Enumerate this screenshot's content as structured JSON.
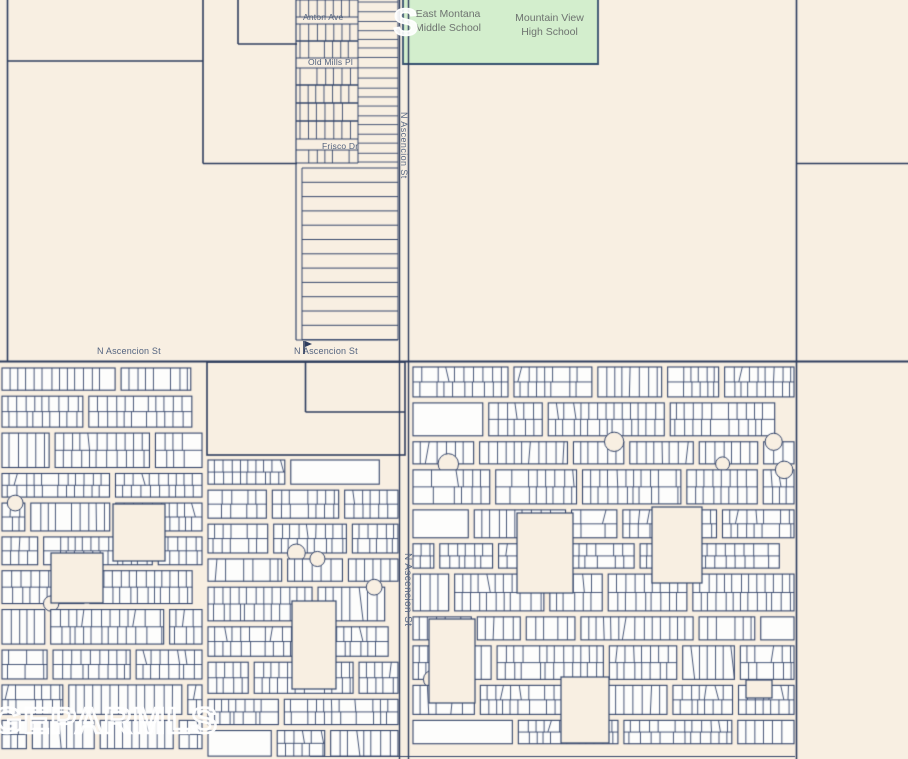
{
  "schools": {
    "middle": "East Montana\nMiddle School",
    "high": "Mountain View\nHigh School"
  },
  "streets": {
    "anton": "Anton Ave",
    "old_mills": "Old Mills Pl",
    "frisco": "Frisco Dr",
    "ascencion_label_west": "N Ascencion St",
    "ascencion_label_east": "N Ascencion St",
    "ascencion_road_upper": "N Ascencion St",
    "ascencion_road_lower": "N Ascencion St"
  },
  "watermark": {
    "text": "GEPARMLS",
    "fragment": "S"
  },
  "colors": {
    "background": "#f8efe2",
    "parcel_fill": "#fdfdfc",
    "line": "#2e3d5e",
    "thin_line": "#35466b",
    "school_area": "#d3eecd",
    "school_border": "#35506e",
    "school_text": "#6e7370",
    "street_text": "#53637f",
    "watermark": "#ffffff"
  }
}
